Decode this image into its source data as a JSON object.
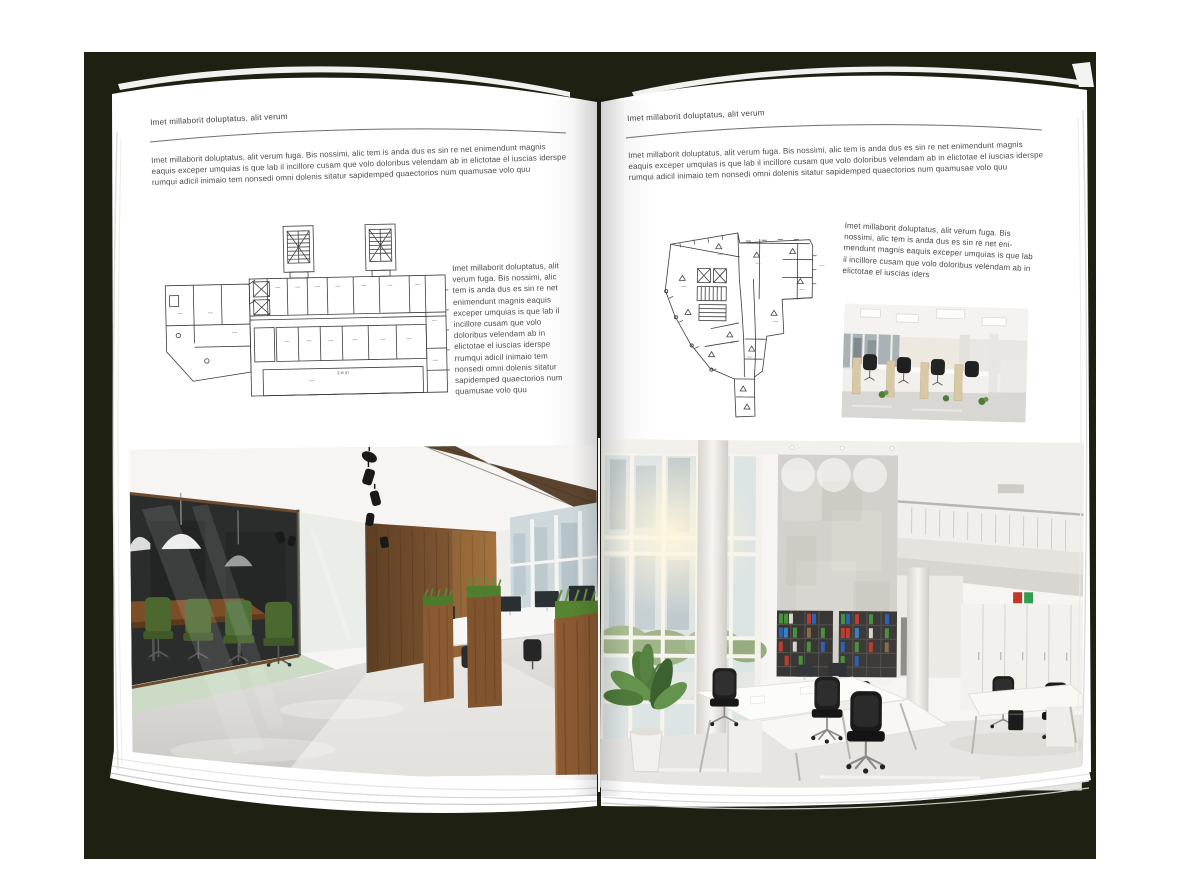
{
  "document": {
    "kind": "open-magazine-spread-mockup"
  },
  "colors": {
    "backdrop": "#1e2012",
    "page": "#ffffff",
    "body_text": "#4b4b4b",
    "header_rule": "#6f6f6f",
    "plan_line": "#3c3c3c",
    "binder_green": "#47923d",
    "binder_red": "#c23b2e",
    "binder_blue": "#2e62b5",
    "wood": "#7a5230",
    "chair_green": "#4c682f"
  },
  "left_page": {
    "header": "Imet millaborit doluptatus, alit verum",
    "intro": "Imet millaborit doluptatus, alit verum fuga. Bis nossimi, alic tem is anda dus es sin re net enimendunt magnis eaquis exceper umquias is que lab il incillore cusam que volo doloribus velendam ab in elictotae el iuscias iderspe rumqui adicil inimaio tem nonsedi omni dolenis sitatur sapidemped quaectorios num quamusae volo quu",
    "side_text": "Imet millaborit doluptatus, alit verum fuga. Bis nossimi, alic tem is anda dus es sin re net enimendunt magnis eaquis exceper umquias is que lab il incillore cusam que volo doloribus velendam ab in elictotae el iuscias iderspe rrumqui adicil inimaio tem nonsedi omni dolenis sitatur sapidemped quaectorios num quamusae volo quu",
    "floorplan_caption": "2-й эт"
  },
  "right_page": {
    "header": "Imet millaborit doluptatus, alit verum",
    "intro": "Imet millaborit doluptatus, alit verum fuga. Bis nossimi, alic tem is anda dus es sin re net enimendunt magnis eaquis exceper umquias is que lab il incillore cusam que volo doloribus velendam ab in elictotae el iuscias iderspe rumqui adicil inimaio tem nonsedi omni dolenis sitatur sapidemped quaectorios num quamusae volo quu",
    "side_text": "Imet millaborit doluptatus, alit verum fuga. Bis nossimi, alic tem is anda dus es sin re net eni-mendunt magnis eaquis exceper umquias is que lab il incillore cusam que volo doloribus velendam ab in elictotae el iuscias iders"
  }
}
